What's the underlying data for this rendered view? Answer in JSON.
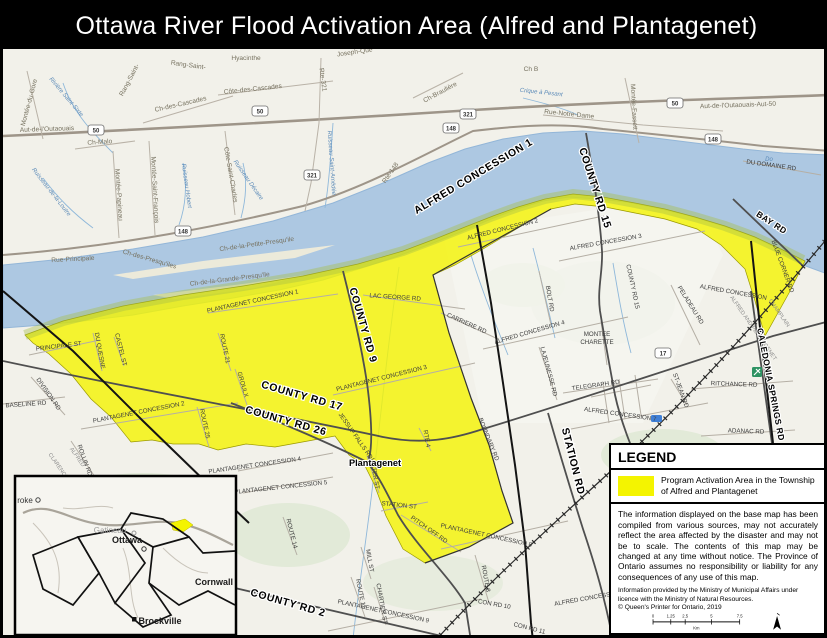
{
  "title": "Ottawa River Flood Activation Area (Alfred and Plantagenet)",
  "legend": {
    "heading": "LEGEND",
    "item_label": "Program Activation Area in the Township of Alfred and Plantagenet",
    "disclaimer": "The information displayed on the base map has been compiled from various sources, may not accurately reflect the area affected by the disaster and may not be to scale. The contents of this map may be changed at any time without notice. The Province of Ontario assumes no responsibility or liability for any consequences of any use of this map.",
    "attribution": "Information provided by the Ministry of Municipal Affairs under licence with the Ministry of Natural Resources.\n© Queen's Printer for Ontario, 2019",
    "colors": {
      "activation": "#f4f400"
    },
    "scale": {
      "unit": "Km",
      "ticks": [
        {
          "x": 8,
          "label": "0"
        },
        {
          "x": 35,
          "label": "1.25"
        },
        {
          "x": 57,
          "label": "2.5"
        },
        {
          "x": 97,
          "label": "5"
        },
        {
          "x": 140,
          "label": "7.5"
        }
      ]
    }
  },
  "inset": {
    "labels": [
      {
        "t": "roke",
        "x": 22,
        "y": 500,
        "c": "ins-dk"
      },
      {
        "t": "Gatineau",
        "x": 107,
        "y": 530,
        "c": "ins-gr"
      },
      {
        "t": "Ottawa",
        "x": 124,
        "y": 540,
        "c": "ins-bk"
      },
      {
        "t": "Cornwall",
        "x": 211,
        "y": 582,
        "c": "ins-bk"
      },
      {
        "t": "Brockville",
        "x": 157,
        "y": 621,
        "c": "ins-bk"
      }
    ]
  },
  "map": {
    "shields": [
      {
        "t": "50",
        "x": 257,
        "y": 108
      },
      {
        "t": "50",
        "x": 93,
        "y": 127
      },
      {
        "t": "50",
        "x": 672,
        "y": 100
      },
      {
        "t": "148",
        "x": 180,
        "y": 228
      },
      {
        "t": "148",
        "x": 448,
        "y": 125
      },
      {
        "t": "148",
        "x": 710,
        "y": 136
      },
      {
        "t": "321",
        "x": 465,
        "y": 111
      },
      {
        "t": "321",
        "x": 309,
        "y": 172
      },
      {
        "t": "17",
        "x": 660,
        "y": 350
      }
    ],
    "labels": [
      {
        "t": "Montée-du-Gore",
        "x": 28,
        "y": 100,
        "r": -75,
        "c": "qc"
      },
      {
        "t": "Rivière Saint-Sixte",
        "x": 62,
        "y": 95,
        "r": 50,
        "c": "wtr"
      },
      {
        "t": "Rang-Saint-",
        "x": 128,
        "y": 78,
        "r": -62,
        "c": "qc"
      },
      {
        "t": "Rang-Saint-",
        "x": 185,
        "y": 64,
        "r": 8,
        "c": "qc"
      },
      {
        "t": "Hyacinthe",
        "x": 243,
        "y": 57,
        "r": 0,
        "c": "qc"
      },
      {
        "t": "Joseph-Que",
        "x": 352,
        "y": 51,
        "r": -8,
        "c": "qc"
      },
      {
        "t": "Ch-des-Cascades",
        "x": 178,
        "y": 103,
        "r": -13,
        "c": "qc"
      },
      {
        "t": "Côte-des-Cascades",
        "x": 250,
        "y": 88,
        "r": -6,
        "c": "qc"
      },
      {
        "t": "Aut-de-l'Outaouais",
        "x": 44,
        "y": 128,
        "r": -2,
        "c": "qc"
      },
      {
        "t": "Ch-Malo",
        "x": 97,
        "y": 141,
        "r": -4,
        "c": "qc"
      },
      {
        "t": "Montée-Papineau",
        "x": 114,
        "y": 192,
        "r": 86,
        "c": "qc"
      },
      {
        "t": "Montée-Saint-François",
        "x": 150,
        "y": 187,
        "r": 87,
        "c": "qc"
      },
      {
        "t": "Côte-Saint-Charles",
        "x": 226,
        "y": 172,
        "r": 80,
        "c": "qc"
      },
      {
        "t": "Ruisseau Hobert",
        "x": 182,
        "y": 183,
        "r": 82,
        "c": "wtr"
      },
      {
        "t": "Ruisseau Décaire",
        "x": 244,
        "y": 178,
        "r": 55,
        "c": "wtr"
      },
      {
        "t": "Ruisseau-de-la-Loutre",
        "x": 47,
        "y": 190,
        "r": 52,
        "c": "wtr"
      },
      {
        "t": "Rue-Principale",
        "x": 70,
        "y": 258,
        "r": -3,
        "c": "qc"
      },
      {
        "t": "Ch-des-Presqu'iles",
        "x": 146,
        "y": 258,
        "r": 16,
        "c": "qc"
      },
      {
        "t": "Ch-de-la-Grande-Presqu'ile",
        "x": 227,
        "y": 278,
        "r": -7,
        "c": "qc"
      },
      {
        "t": "Ch-de-la-Petite-Presqu'ile",
        "x": 254,
        "y": 243,
        "r": -8,
        "c": "qc"
      },
      {
        "t": "Rte-321",
        "x": 318,
        "y": 77,
        "r": 82,
        "c": "qc"
      },
      {
        "t": "Ruisseau Saint-Amédée",
        "x": 327,
        "y": 160,
        "r": 86,
        "c": "wtr"
      },
      {
        "t": "Ch-Braulière",
        "x": 438,
        "y": 91,
        "r": -28,
        "c": "qc"
      },
      {
        "t": "Ch B",
        "x": 528,
        "y": 68,
        "r": 0,
        "c": "qc"
      },
      {
        "t": "Crique à Pesant",
        "x": 538,
        "y": 91,
        "r": 6,
        "c": "wtr"
      },
      {
        "t": "Rue-Notre-Dame",
        "x": 566,
        "y": 113,
        "r": 6,
        "c": "qc"
      },
      {
        "t": "Montée-Fassett",
        "x": 629,
        "y": 104,
        "r": 87,
        "c": "qc"
      },
      {
        "t": "Aut-de-l'Outaouais-Aut-50",
        "x": 735,
        "y": 104,
        "r": -2,
        "c": "qc"
      },
      {
        "t": "Rte-148",
        "x": 389,
        "y": 171,
        "r": -55,
        "c": "qc"
      },
      {
        "t": "Do",
        "x": 766,
        "y": 158,
        "r": 0,
        "c": "wtr"
      },
      {
        "t": "ALFRED CONCESSION 2",
        "x": 500,
        "y": 228,
        "r": -14,
        "c": "on"
      },
      {
        "t": "ALFRED CONCESSION 3",
        "x": 603,
        "y": 241,
        "r": -10,
        "c": "on"
      },
      {
        "t": "ALFRED CONCESSION 4",
        "x": 527,
        "y": 331,
        "r": -16,
        "c": "on"
      },
      {
        "t": "ALFRED CONCESSION 7",
        "x": 617,
        "y": 413,
        "r": 8,
        "c": "on"
      },
      {
        "t": "ALFRED CONCESSION",
        "x": 730,
        "y": 291,
        "r": 10,
        "c": "on"
      },
      {
        "t": "ALFRED CONCESSION",
        "x": 585,
        "y": 597,
        "r": -10,
        "c": "on"
      },
      {
        "t": "DU DOMAINE RD",
        "x": 768,
        "y": 164,
        "r": 8,
        "c": "on"
      },
      {
        "t": "MONTEE",
        "x": 594,
        "y": 333,
        "r": 0,
        "c": "on"
      },
      {
        "t": "CHARETTE",
        "x": 594,
        "y": 341,
        "r": 0,
        "c": "on"
      },
      {
        "t": "TELEGRAPH RD",
        "x": 593,
        "y": 384,
        "r": -8,
        "c": "on"
      },
      {
        "t": "LAJEUNESSE RD",
        "x": 544,
        "y": 369,
        "r": 75,
        "c": "on"
      },
      {
        "t": "BOLT RD",
        "x": 545,
        "y": 296,
        "r": 80,
        "c": "on"
      },
      {
        "t": "RITCHANCE RD",
        "x": 731,
        "y": 383,
        "r": 2,
        "c": "on"
      },
      {
        "t": "ADANAC RD",
        "x": 743,
        "y": 430,
        "r": 2,
        "c": "on"
      },
      {
        "t": "PELADEAU RD",
        "x": 686,
        "y": 303,
        "r": 58,
        "c": "on"
      },
      {
        "t": "ST-JEAN RD",
        "x": 676,
        "y": 388,
        "r": 70,
        "c": "on"
      },
      {
        "t": "CARRIERE RD",
        "x": 463,
        "y": 322,
        "r": 24,
        "c": "on"
      },
      {
        "t": "LAC GEORGE RD",
        "x": 392,
        "y": 296,
        "r": 4,
        "c": "on"
      },
      {
        "t": "COUNTY RD 15",
        "x": 628,
        "y": 284,
        "r": 78,
        "c": "on"
      },
      {
        "t": "PLANTAGENET CONCESSION 1",
        "x": 250,
        "y": 300,
        "r": -12,
        "c": "on"
      },
      {
        "t": "PLANTAGENET CONCESSION 2",
        "x": 136,
        "y": 411,
        "r": -11,
        "c": "on"
      },
      {
        "t": "PLANTAGENET CONCESSION 3",
        "x": 379,
        "y": 377,
        "r": -14,
        "c": "on"
      },
      {
        "t": "PLANTAGENET CONCESSION 4",
        "x": 252,
        "y": 464,
        "r": -8,
        "c": "on"
      },
      {
        "t": "PLANTAGENET CONCESSION 5",
        "x": 278,
        "y": 486,
        "r": -6,
        "c": "on"
      },
      {
        "t": "PLANTAGENET CONCESSION 8",
        "x": 483,
        "y": 534,
        "r": 12,
        "c": "on"
      },
      {
        "t": "PLANTAGENET CONCESSION 9",
        "x": 380,
        "y": 610,
        "r": 12,
        "c": "on"
      },
      {
        "t": "ROUTE 21",
        "x": 220,
        "y": 346,
        "r": 78,
        "c": "on"
      },
      {
        "t": "GROULX",
        "x": 238,
        "y": 382,
        "r": 74,
        "c": "on"
      },
      {
        "t": "ROUTE 25",
        "x": 200,
        "y": 421,
        "r": 78,
        "c": "on"
      },
      {
        "t": "ROUTE 14",
        "x": 287,
        "y": 531,
        "r": 76,
        "c": "on"
      },
      {
        "t": "MILL ST",
        "x": 365,
        "y": 558,
        "r": 80,
        "c": "on"
      },
      {
        "t": "ROUTE 11",
        "x": 356,
        "y": 591,
        "r": 78,
        "c": "on"
      },
      {
        "t": "CHARTIER ST",
        "x": 377,
        "y": 601,
        "r": 80,
        "c": "on"
      },
      {
        "t": "ROUTE 8",
        "x": 481,
        "y": 576,
        "r": 80,
        "c": "on"
      },
      {
        "t": "WATER ST",
        "x": 370,
        "y": 471,
        "r": 80,
        "c": "on"
      },
      {
        "t": "JESSUP FALLS RD",
        "x": 351,
        "y": 434,
        "r": 55,
        "c": "on"
      },
      {
        "t": "STATION ST",
        "x": 396,
        "y": 504,
        "r": 6,
        "c": "on"
      },
      {
        "t": "PITCH OFF RD",
        "x": 425,
        "y": 528,
        "r": 35,
        "c": "on"
      },
      {
        "t": "BOUNDARY RD",
        "x": 484,
        "y": 437,
        "r": 68,
        "c": "on"
      },
      {
        "t": "CON RD 10",
        "x": 491,
        "y": 603,
        "r": 10,
        "c": "on"
      },
      {
        "t": "CON RD 11",
        "x": 526,
        "y": 627,
        "r": 14,
        "c": "on"
      },
      {
        "t": "CON RD 5",
        "x": 689,
        "y": 631,
        "r": -4,
        "c": "on"
      },
      {
        "t": "PRINCIPALE ST",
        "x": 56,
        "y": 345,
        "r": -7,
        "c": "on"
      },
      {
        "t": "DU QUESNE",
        "x": 95,
        "y": 348,
        "r": 80,
        "c": "on"
      },
      {
        "t": "CASTEL ST",
        "x": 116,
        "y": 347,
        "r": 76,
        "c": "on"
      },
      {
        "t": "DIVISION RD",
        "x": 44,
        "y": 392,
        "r": 55,
        "c": "on"
      },
      {
        "t": "BASELINE RD",
        "x": 23,
        "y": 403,
        "r": -4,
        "c": "on"
      },
      {
        "t": "ROLLIN RD",
        "x": 80,
        "y": 458,
        "r": 70,
        "c": "on"
      },
      {
        "t": "RTE 4",
        "x": 422,
        "y": 436,
        "r": 80,
        "c": "on"
      },
      {
        "t": "BLUE CORNER RD",
        "x": 778,
        "y": 264,
        "r": 70,
        "c": "on"
      },
      {
        "t": "ALFRED AND PLANTAGENET",
        "x": 749,
        "y": 326,
        "r": 55,
        "c": "bdy"
      },
      {
        "t": "CHAMPLAIN",
        "x": 775,
        "y": 311,
        "r": 55,
        "c": "bdy"
      },
      {
        "t": "CLARENCE",
        "x": 54,
        "y": 464,
        "r": 55,
        "c": "bdy"
      },
      {
        "t": "ALFRED",
        "x": 73,
        "y": 455,
        "r": 55,
        "c": "bdy"
      },
      {
        "t": "ALFRED CONCESSION 1",
        "x": 472,
        "y": 176,
        "r": -31,
        "c": "big"
      },
      {
        "t": "COUNTY RD 15",
        "x": 589,
        "y": 186,
        "r": 72,
        "c": "big"
      },
      {
        "t": "COUNTY RD 9",
        "x": 357,
        "y": 323,
        "r": 74,
        "c": "big"
      },
      {
        "t": "COUNTY RD 17",
        "x": 298,
        "y": 396,
        "r": 16,
        "c": "big"
      },
      {
        "t": "COUNTY RD 26",
        "x": 282,
        "y": 421,
        "r": 16,
        "c": "big"
      },
      {
        "t": "COUNTY RD 2",
        "x": 284,
        "y": 603,
        "r": 16,
        "c": "big"
      },
      {
        "t": "STATION RD",
        "x": 567,
        "y": 459,
        "r": 76,
        "c": "big"
      },
      {
        "t": "CALEDONIA SPRINGS RD",
        "x": 765,
        "y": 382,
        "r": 79,
        "c": "big2"
      },
      {
        "t": "BAY RD",
        "x": 767,
        "y": 222,
        "r": 33,
        "c": "big2"
      },
      {
        "t": "Plantagenet",
        "x": 372,
        "y": 463,
        "r": 0,
        "c": "town"
      }
    ]
  }
}
